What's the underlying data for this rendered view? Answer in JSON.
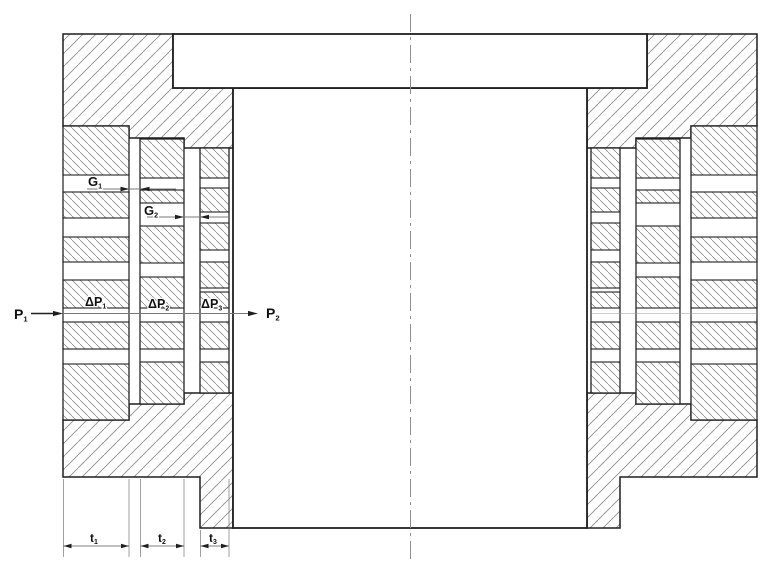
{
  "colors": {
    "background": "#ffffff",
    "outline": "#1f1f1f",
    "hatch": "#8e8e8e",
    "annotation": "#787878",
    "faint": "#9a9a9a",
    "centerline": "#8f8f8f",
    "label_text": "#111111"
  },
  "diagram": {
    "canvas": {
      "width": 769,
      "height": 563
    },
    "centerline": {
      "name": "axis-centerline",
      "x": 410.5,
      "y1": 14,
      "y2": 560
    },
    "flange": {
      "name": "piston-flange",
      "x": 173,
      "y": 34,
      "width": 474,
      "height": 54
    },
    "piston": {
      "name": "piston-body",
      "x": 233,
      "y": 88,
      "width": 354,
      "height": 440
    },
    "housings": [
      {
        "name": "housing-top-left",
        "points": "63,34 173,34 173,88 233,88 233,148 184,148 184,138 129,138 129,126 63,126"
      },
      {
        "name": "housing-top-right",
        "points": "757,34 647,34 647,88 587,88 587,148 636,148 636,138 691,138 691,126 757,126"
      },
      {
        "name": "housing-bottom-left",
        "points": "63,420 129,420 129,404 184,404 184,393 233,393 233,528 200,528 200,477 63,477"
      },
      {
        "name": "housing-bottom-right",
        "points": "757,420 691,420 691,404 636,404 636,393 587,393 587,528 620,528 620,477 757,477"
      }
    ],
    "rings": [
      {
        "name": "seal-ring-1-left",
        "x": 63,
        "width": 66,
        "top": 126,
        "bottom": 420,
        "teeth": [
          [
            126,
            175
          ],
          [
            192,
            218
          ],
          [
            237,
            262
          ],
          [
            280,
            308
          ],
          [
            322,
            349
          ],
          [
            364,
            420
          ]
        ]
      },
      {
        "name": "seal-ring-2-left",
        "x": 140,
        "width": 44,
        "top": 139,
        "bottom": 404,
        "teeth": [
          [
            139,
            178
          ],
          [
            190,
            203
          ],
          [
            226,
            263
          ],
          [
            277,
            308
          ],
          [
            322,
            349
          ],
          [
            362,
            404
          ]
        ]
      },
      {
        "name": "seal-ring-3-left",
        "x": 200,
        "width": 29,
        "top": 148,
        "bottom": 393,
        "teeth": [
          [
            148,
            178
          ],
          [
            188,
            212
          ],
          [
            223,
            250
          ],
          [
            262,
            288
          ],
          [
            292,
            308
          ],
          [
            322,
            349
          ],
          [
            362,
            393
          ]
        ]
      },
      {
        "name": "seal-ring-1-right",
        "x": 691,
        "width": 66,
        "top": 126,
        "bottom": 420,
        "teeth": [
          [
            126,
            175
          ],
          [
            192,
            218
          ],
          [
            237,
            262
          ],
          [
            280,
            308
          ],
          [
            322,
            349
          ],
          [
            364,
            420
          ]
        ]
      },
      {
        "name": "seal-ring-2-right",
        "x": 636,
        "width": 44,
        "top": 139,
        "bottom": 404,
        "teeth": [
          [
            139,
            178
          ],
          [
            190,
            203
          ],
          [
            226,
            263
          ],
          [
            277,
            308
          ],
          [
            322,
            349
          ],
          [
            362,
            404
          ]
        ]
      },
      {
        "name": "seal-ring-3-right",
        "x": 591,
        "width": 29,
        "top": 148,
        "bottom": 393,
        "teeth": [
          [
            148,
            178
          ],
          [
            188,
            212
          ],
          [
            223,
            250
          ],
          [
            262,
            288
          ],
          [
            292,
            308
          ],
          [
            322,
            349
          ],
          [
            362,
            393
          ]
        ]
      }
    ],
    "flow_lines": [
      {
        "name": "p1-arrow-shaft",
        "x1": 31,
        "y1": 313.5,
        "x2": 54,
        "y2": 313.5,
        "width": 1.4,
        "color": "outline"
      },
      {
        "name": "p-flow-line",
        "x1": 63,
        "y1": 313.5,
        "x2": 249,
        "y2": 313.5,
        "width": 0.9,
        "color": "annotation"
      },
      {
        "name": "ring-split-line-right",
        "x1": 591,
        "y1": 313.5,
        "x2": 757,
        "y2": 313.5,
        "width": 0.6,
        "color": "faint"
      },
      {
        "name": "g1-flow-line",
        "x1": 87,
        "y1": 189,
        "x2": 176,
        "y2": 189,
        "width": 0.9,
        "color": "annotation"
      },
      {
        "name": "g2-flow-line",
        "x1": 147,
        "y1": 217,
        "x2": 228,
        "y2": 217,
        "width": 0.9,
        "color": "annotation"
      }
    ],
    "arrowheads": [
      {
        "name": "p1-arrowhead",
        "x": 63,
        "y": 313.5,
        "dir": "right",
        "len": 10,
        "half": 2.6
      },
      {
        "name": "p2-arrowhead",
        "x": 258,
        "y": 313.5,
        "dir": "right",
        "len": 10,
        "half": 2.6
      },
      {
        "name": "g1-arrowhead-exit",
        "x": 129.5,
        "y": 189,
        "dir": "right",
        "len": 9,
        "half": 2.2
      },
      {
        "name": "g1-arrowhead-entry",
        "x": 140.5,
        "y": 189,
        "dir": "left",
        "len": 9,
        "half": 2.2
      },
      {
        "name": "g2-arrowhead-exit",
        "x": 184,
        "y": 217,
        "dir": "right",
        "len": 9,
        "half": 2.2
      },
      {
        "name": "g2-arrowhead-entry",
        "x": 200,
        "y": 217,
        "dir": "left",
        "len": 9,
        "half": 2.2
      }
    ],
    "labels": [
      {
        "name": "label-p1",
        "text": "P",
        "sub": "1",
        "x": 14,
        "y": 319,
        "size": 14
      },
      {
        "name": "label-p2",
        "text": "P",
        "sub": "2",
        "x": 266,
        "y": 318,
        "size": 14
      },
      {
        "name": "label-g1",
        "text": "G",
        "sub": "1",
        "x": 88,
        "y": 186,
        "size": 13
      },
      {
        "name": "label-g2",
        "text": "G",
        "sub": "2",
        "x": 144,
        "y": 215,
        "size": 13
      },
      {
        "name": "label-delta-p1",
        "text": "ΔP",
        "sub": "1",
        "x": 85,
        "y": 306,
        "size": 12.5
      },
      {
        "name": "label-delta-p2",
        "text": "ΔP",
        "sub": "2",
        "x": 148,
        "y": 308,
        "size": 12.5
      },
      {
        "name": "label-delta-p3",
        "text": "ΔP",
        "sub": "3",
        "x": 201,
        "y": 308,
        "size": 12.5
      }
    ],
    "dimensions": [
      {
        "name": "dim-t1",
        "text": "t",
        "sub": "1",
        "x1": 63.5,
        "x2": 129,
        "y": 546,
        "label_x": 90,
        "label_y": 542,
        "size": 12,
        "ext": [
          {
            "x": 63.5,
            "y1": 479,
            "y2": 557
          },
          {
            "x": 129,
            "y1": 479,
            "y2": 557
          }
        ]
      },
      {
        "name": "dim-t2",
        "text": "t",
        "sub": "2",
        "x1": 140.5,
        "x2": 184,
        "y": 546,
        "label_x": 158,
        "label_y": 542,
        "size": 12,
        "ext": [
          {
            "x": 140.5,
            "y1": 479,
            "y2": 557
          },
          {
            "x": 184,
            "y1": 479,
            "y2": 557
          }
        ]
      },
      {
        "name": "dim-t3",
        "text": "t",
        "sub": "3",
        "x1": 200.5,
        "x2": 229,
        "y": 546,
        "label_x": 209,
        "label_y": 542,
        "size": 12,
        "ext": [
          {
            "x": 200.5,
            "y1": 530,
            "y2": 557
          },
          {
            "x": 229,
            "y1": 479,
            "y2": 557
          }
        ]
      }
    ]
  }
}
